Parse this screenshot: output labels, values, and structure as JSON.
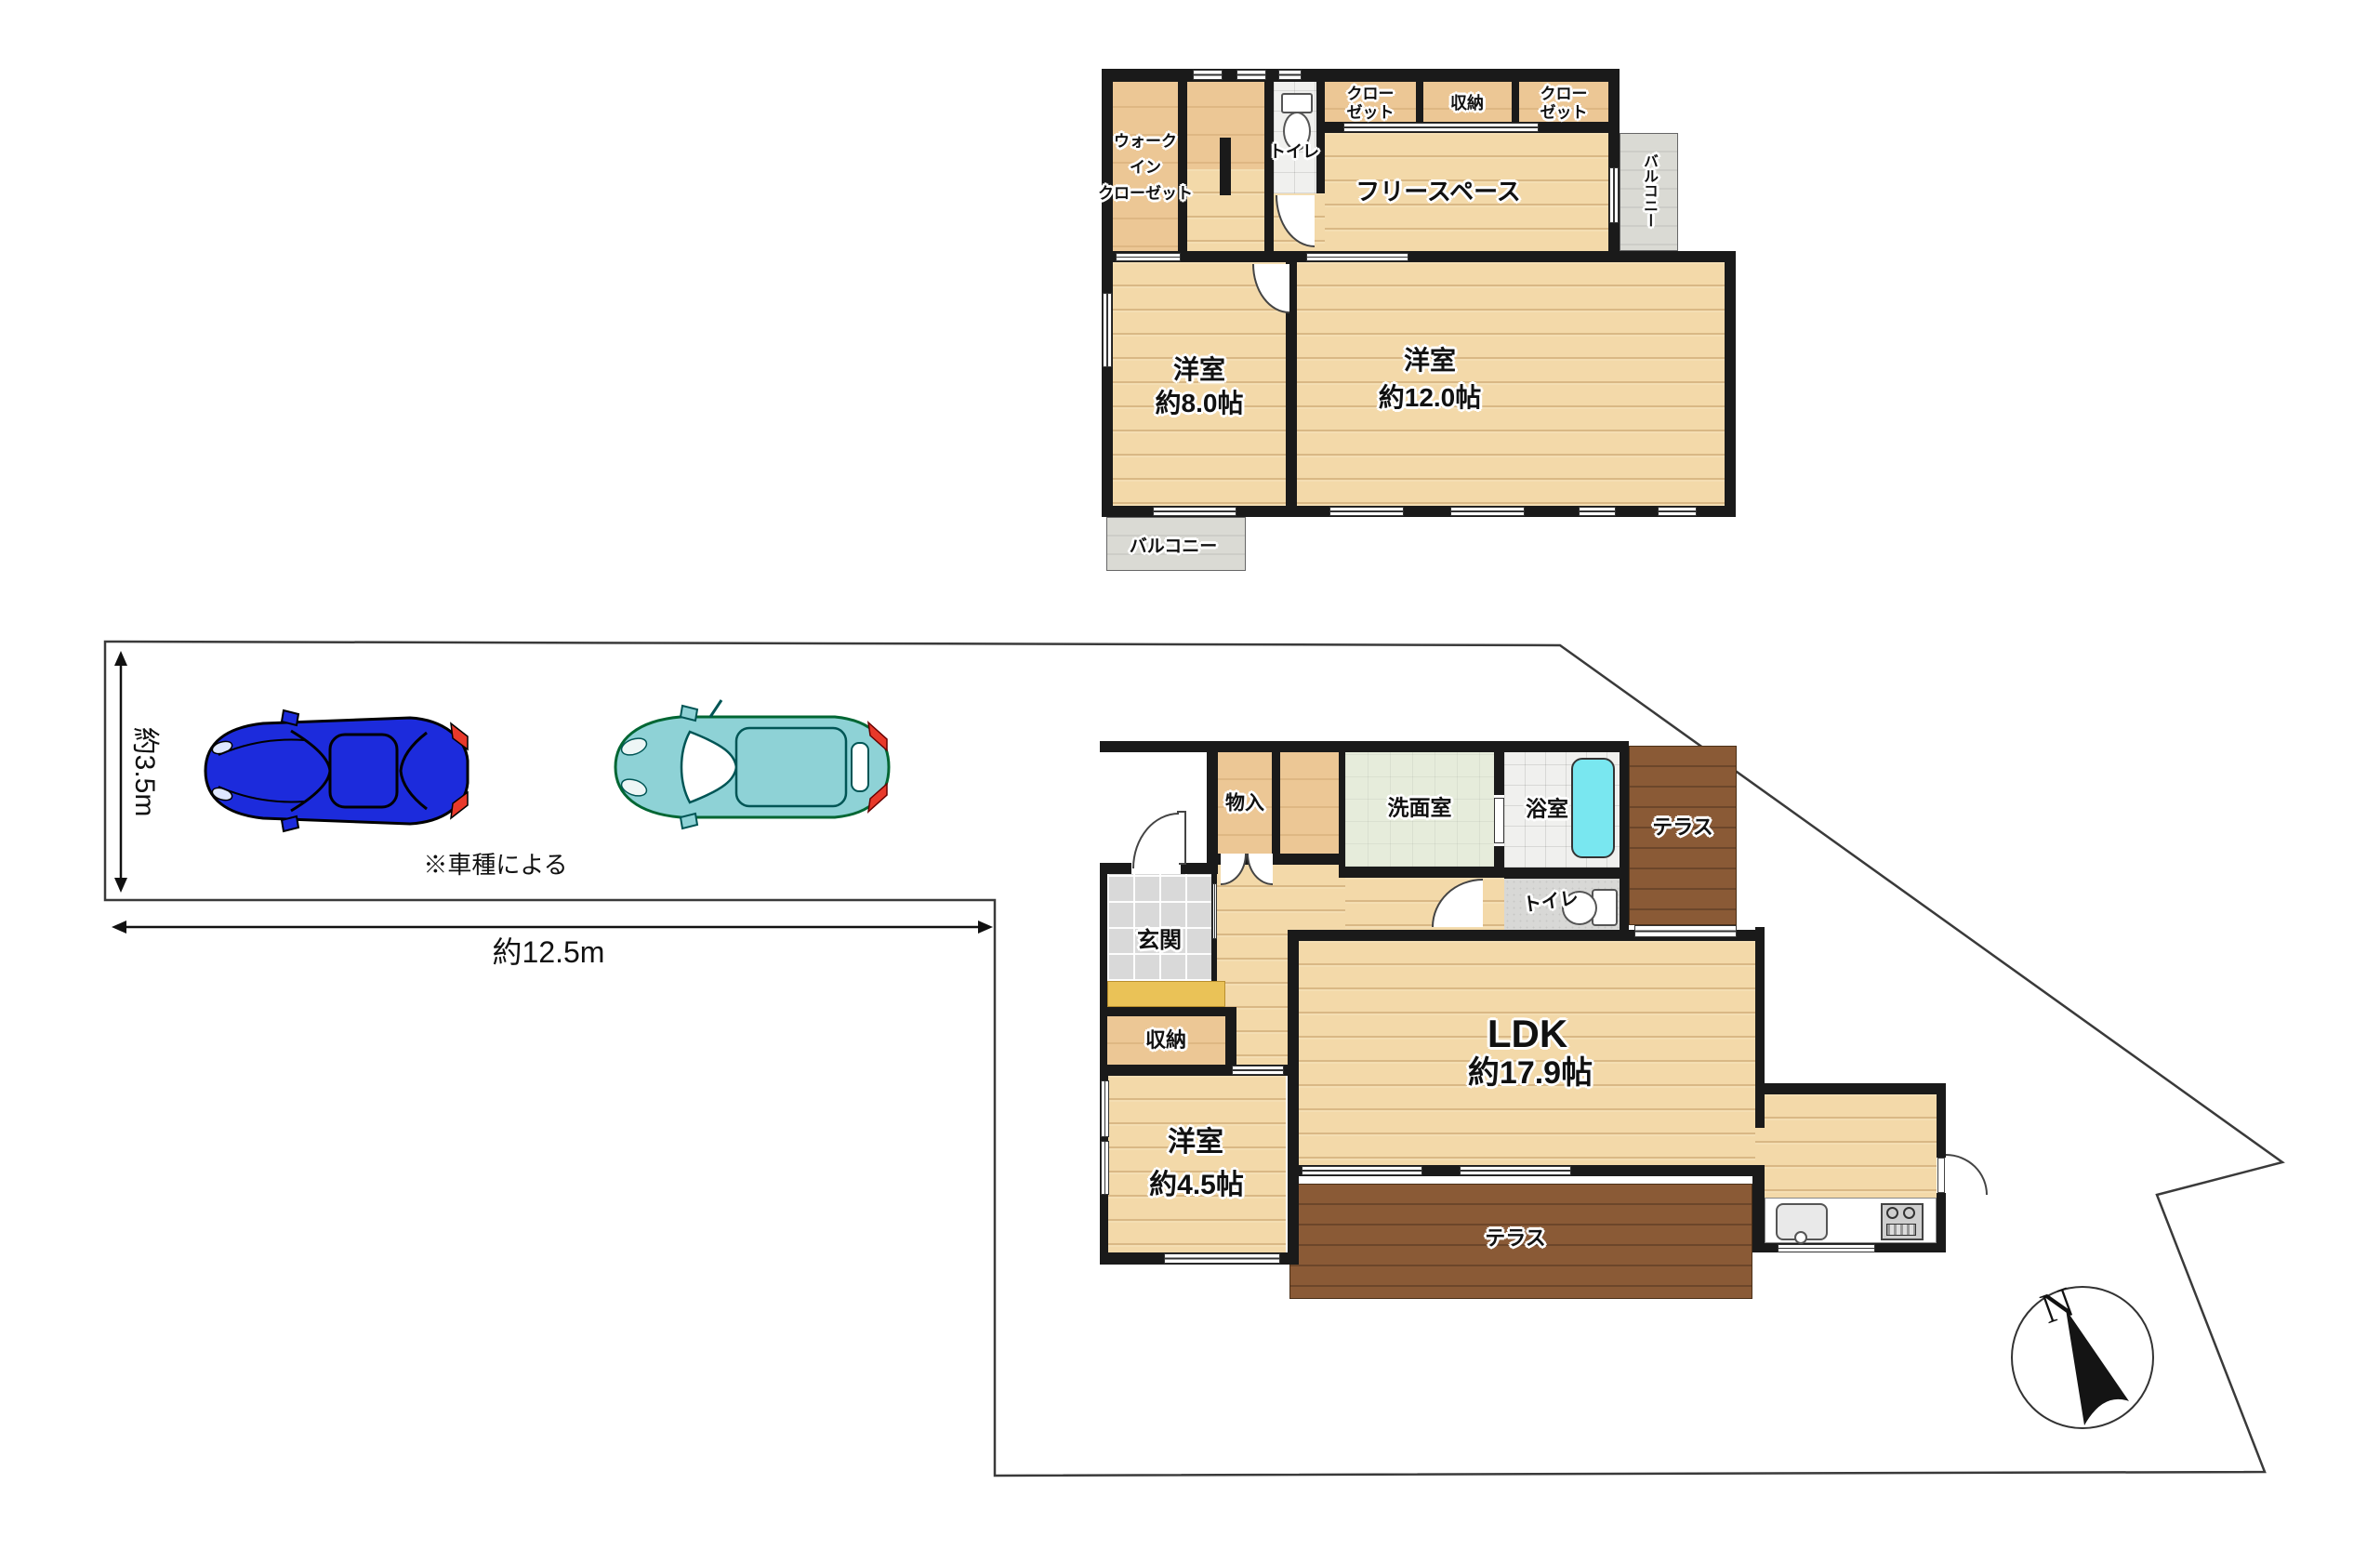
{
  "site": {
    "width_label": "約12.5m",
    "depth_label": "約3.5m",
    "car_note": "※車種による",
    "compass_north": "N"
  },
  "floor2": {
    "walk_in_closet_line1": "ウォーク",
    "walk_in_closet_line2": "イン",
    "walk_in_closet_line3": "クローゼット",
    "toilet": "トイレ",
    "closet_left_line1": "クロー",
    "closet_left_line2": "ゼット",
    "storage": "収納",
    "closet_right_line1": "クロー",
    "closet_right_line2": "ゼット",
    "balcony_side": "バルコニー",
    "free_space": "フリースペース",
    "bedroom8_name": "洋室",
    "bedroom8_size": "約8.0帖",
    "bedroom12_name": "洋室",
    "bedroom12_size": "約12.0帖",
    "balcony_bottom": "バルコニー"
  },
  "floor1": {
    "storage_hall": "物入",
    "washroom": "洗面室",
    "bathroom": "浴室",
    "terrace_upper": "テラス",
    "entrance": "玄関",
    "toilet": "トイレ",
    "storage": "収納",
    "ldk_name": "LDK",
    "ldk_size": "約17.9帖",
    "bedroom_name": "洋室",
    "bedroom_size": "約4.5帖",
    "terrace_lower": "テラス"
  },
  "colors": {
    "wall": "#1a1a1a",
    "wood_light": "#f3d9a9",
    "wood_beige": "#ecc795",
    "wood_dark": "#8a5a36",
    "balcony_gray": "#dadad4",
    "tub_cyan": "#79e7f0",
    "step_yellow": "#eac257",
    "car_blue": "#1c2bdc",
    "car_teal": "#8ed2d6",
    "tail_red": "#e8392a"
  },
  "icons": {
    "compass": "compass-north-icon",
    "car_blue": "car-top-view-blue-icon",
    "car_teal": "car-top-view-teal-icon",
    "toilet": "toilet-icon",
    "bathtub": "bathtub-icon",
    "sink": "kitchen-sink-icon",
    "stove": "stove-icon"
  }
}
